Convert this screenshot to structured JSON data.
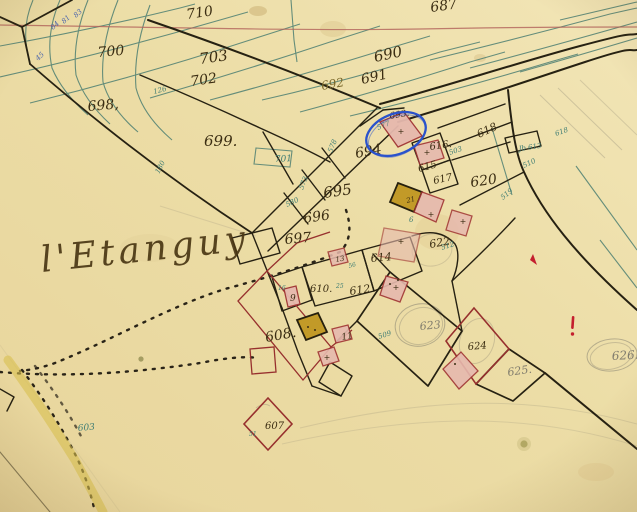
{
  "place_name": "l'Etanguy",
  "palette": {
    "paper": "#ecdda6",
    "paper_light": "#f2e5b6",
    "ink": "#3b2d12",
    "ink2": "#7a682a",
    "teal_line": "#4d7f72",
    "teal_text": "#3f7d74",
    "blue_text": "#4a64ad",
    "pencil": "#807c6d",
    "crimson": "#97302e",
    "pink_fill": "#e6b9ae",
    "olive_fill": "#c29a28",
    "red_line": "#b2625a",
    "annotation_blue": "#2a52cc",
    "yellow_road": "#d9c050"
  },
  "annotation": {
    "shape": "ellipse",
    "around_parcel": "693"
  },
  "labels": [
    {
      "t": "710",
      "x": 187,
      "y": 19,
      "s": 14,
      "r": -8
    },
    {
      "t": "700",
      "x": 98,
      "y": 57,
      "s": 14,
      "r": -5
    },
    {
      "t": "703",
      "x": 200,
      "y": 64,
      "s": 15,
      "r": -8
    },
    {
      "t": "702",
      "x": 191,
      "y": 86,
      "s": 14,
      "r": -8
    },
    {
      "t": "698,",
      "x": 88,
      "y": 111,
      "s": 14,
      "r": -5
    },
    {
      "t": "699.",
      "x": 204,
      "y": 146,
      "s": 15,
      "r": 0
    },
    {
      "t": "687",
      "x": 431,
      "y": 12,
      "s": 14,
      "r": -8
    },
    {
      "t": "690",
      "x": 375,
      "y": 62,
      "s": 15,
      "r": -12
    },
    {
      "t": "691",
      "x": 362,
      "y": 84,
      "s": 14,
      "r": -12
    },
    {
      "t": "692",
      "x": 322,
      "y": 90,
      "s": 12,
      "r": -10,
      "k": "ink2"
    },
    {
      "t": "694",
      "x": 356,
      "y": 158,
      "s": 14,
      "r": -10
    },
    {
      "t": "695",
      "x": 324,
      "y": 198,
      "s": 15,
      "r": -8
    },
    {
      "t": "696",
      "x": 304,
      "y": 223,
      "s": 14,
      "r": -8
    },
    {
      "t": "697",
      "x": 285,
      "y": 244,
      "s": 14,
      "r": -5
    },
    {
      "t": "693.",
      "x": 390,
      "y": 119,
      "s": 9,
      "r": -10
    },
    {
      "t": "616.",
      "x": 430,
      "y": 150,
      "s": 10,
      "r": -8
    },
    {
      "t": "615",
      "x": 419,
      "y": 172,
      "s": 10,
      "r": -15
    },
    {
      "t": "617",
      "x": 434,
      "y": 184,
      "s": 10,
      "r": -12
    },
    {
      "t": "618",
      "x": 479,
      "y": 138,
      "s": 11,
      "r": -25
    },
    {
      "t": "620",
      "x": 471,
      "y": 187,
      "s": 14,
      "r": -8
    },
    {
      "t": "622",
      "x": 430,
      "y": 248,
      "s": 11,
      "r": -10
    },
    {
      "t": "614",
      "x": 371,
      "y": 262,
      "s": 11,
      "r": -5
    },
    {
      "t": "612",
      "x": 350,
      "y": 295,
      "s": 11,
      "r": -8
    },
    {
      "t": "610.",
      "x": 310,
      "y": 292,
      "s": 10,
      "r": 0
    },
    {
      "t": "608.",
      "x": 266,
      "y": 342,
      "s": 14,
      "r": -10
    },
    {
      "t": "607",
      "x": 265,
      "y": 429,
      "s": 10,
      "r": 0
    },
    {
      "t": "624",
      "x": 468,
      "y": 350,
      "s": 10,
      "r": -5
    },
    {
      "t": "9",
      "x": 290,
      "y": 301,
      "s": 9,
      "r": 0
    },
    {
      "t": "13",
      "x": 336,
      "y": 262,
      "s": 7,
      "r": -10
    },
    {
      "t": "11",
      "x": 342,
      "y": 340,
      "s": 9,
      "r": -10
    },
    {
      "t": "21",
      "x": 407,
      "y": 203,
      "s": 7,
      "r": -15
    },
    {
      "t": "623",
      "x": 420,
      "y": 330,
      "s": 11,
      "r": -5,
      "k": "pencil"
    },
    {
      "t": "625.",
      "x": 508,
      "y": 376,
      "s": 11,
      "r": -8,
      "k": "pencil"
    },
    {
      "t": "626.",
      "x": 612,
      "y": 360,
      "s": 12,
      "r": -3,
      "k": "pencil"
    },
    {
      "t": "701",
      "x": 275,
      "y": 162,
      "s": 9,
      "r": -3,
      "k": "teal"
    },
    {
      "t": "578",
      "x": 332,
      "y": 153,
      "s": 7,
      "r": -68,
      "k": "teal"
    },
    {
      "t": "573",
      "x": 303,
      "y": 190,
      "s": 7,
      "r": -68,
      "k": "teal"
    },
    {
      "t": "580",
      "x": 287,
      "y": 207,
      "s": 7,
      "r": -25,
      "k": "teal"
    },
    {
      "t": "577",
      "x": 378,
      "y": 130,
      "s": 7,
      "r": -22,
      "k": "teal"
    },
    {
      "t": "180",
      "x": 159,
      "y": 174,
      "s": 7,
      "r": -62,
      "k": "teal"
    },
    {
      "t": "126",
      "x": 154,
      "y": 94,
      "s": 7,
      "r": -15,
      "k": "teal"
    },
    {
      "t": "603",
      "x": 78,
      "y": 431,
      "s": 9,
      "r": -5,
      "k": "teal"
    },
    {
      "t": "51",
      "x": 249,
      "y": 436,
      "s": 6,
      "r": 0,
      "k": "teal"
    },
    {
      "t": "509",
      "x": 379,
      "y": 339,
      "s": 7,
      "r": -18,
      "k": "teal"
    },
    {
      "t": "512",
      "x": 442,
      "y": 250,
      "s": 7,
      "r": -18,
      "k": "teal"
    },
    {
      "t": "503",
      "x": 450,
      "y": 155,
      "s": 7,
      "r": -20,
      "k": "teal"
    },
    {
      "t": "510",
      "x": 524,
      "y": 168,
      "s": 7,
      "r": -25,
      "k": "teal"
    },
    {
      "t": "519",
      "x": 503,
      "y": 200,
      "s": 7,
      "r": -40,
      "k": "teal"
    },
    {
      "t": "618",
      "x": 556,
      "y": 136,
      "s": 7,
      "r": -20,
      "k": "teal"
    },
    {
      "t": "Jb 613",
      "x": 519,
      "y": 151,
      "s": 7,
      "r": -8,
      "k": "teal"
    },
    {
      "t": "16",
      "x": 278,
      "y": 290,
      "s": 6,
      "r": 0,
      "k": "teal"
    },
    {
      "t": "25",
      "x": 336,
      "y": 288,
      "s": 6,
      "r": 0,
      "k": "teal"
    },
    {
      "t": "6",
      "x": 409,
      "y": 222,
      "s": 7,
      "r": 0,
      "k": "teal"
    },
    {
      "t": "56",
      "x": 349,
      "y": 268,
      "s": 6,
      "r": -15,
      "k": "teal"
    },
    {
      "t": "84",
      "x": 53,
      "y": 30,
      "s": 7,
      "r": -42,
      "k": "blue"
    },
    {
      "t": "81",
      "x": 64,
      "y": 24,
      "s": 7,
      "r": -42,
      "k": "blue"
    },
    {
      "t": "83",
      "x": 76,
      "y": 18,
      "s": 7,
      "r": -42,
      "k": "blue"
    },
    {
      "t": "45",
      "x": 38,
      "y": 61,
      "s": 7,
      "r": -42,
      "k": "blue"
    }
  ],
  "cross_marks": [
    {
      "x": 401,
      "y": 134
    },
    {
      "x": 427,
      "y": 155
    },
    {
      "x": 431,
      "y": 217
    },
    {
      "x": 401,
      "y": 244
    },
    {
      "x": 396,
      "y": 290
    },
    {
      "x": 327,
      "y": 360
    },
    {
      "x": 463,
      "y": 224
    }
  ]
}
